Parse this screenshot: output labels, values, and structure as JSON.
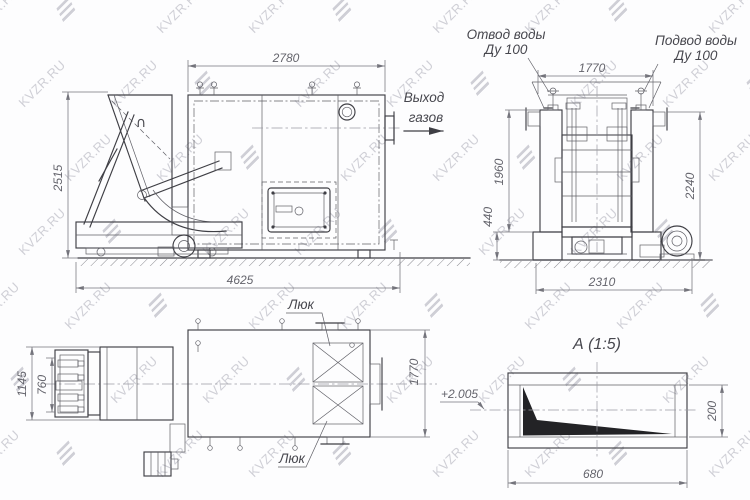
{
  "watermark": {
    "text": "KVZR.RU",
    "color": "#cfcfd6"
  },
  "side_view": {
    "dim_top": "2780",
    "dim_left": "2515",
    "dim_bottom": "4625",
    "hopper_mark": "∩",
    "gas_label_line1": "Выход",
    "gas_label_line2": "газов"
  },
  "front_view": {
    "label_outlet_line1": "Отвод воды",
    "label_outlet_line2": "Ду 100",
    "label_inlet_line1": "Подвод воды",
    "label_inlet_line2": "Ду 100",
    "dim_top": "1770",
    "dim_left": "1960",
    "dim_left_lower": "440",
    "dim_right": "2240",
    "dim_bottom": "2310"
  },
  "plan_view": {
    "hatch_label_top": "Люк",
    "hatch_label_bottom": "Люк",
    "dim_left_outer": "1145",
    "dim_left_inner": "760",
    "dim_right": "1770"
  },
  "detail_a": {
    "title": "А  (1:5)",
    "dim_bottom": "680",
    "dim_right": "200",
    "level_mark": "+2.005"
  }
}
